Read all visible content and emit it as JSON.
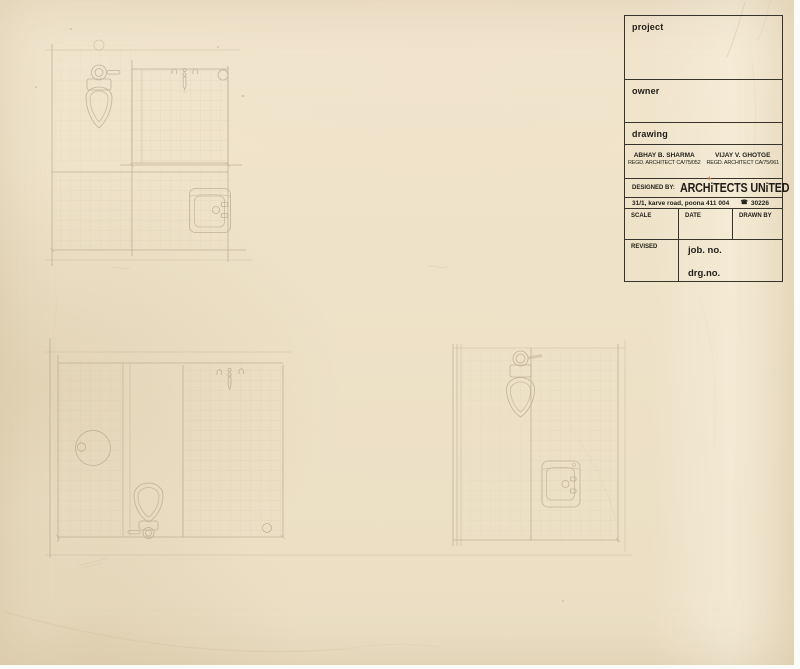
{
  "title_block": {
    "project_label": "project",
    "owner_label": "owner",
    "drawing_label": "drawing",
    "architect_1_name": "ABHAY B. SHARMA",
    "architect_1_reg": "REGD. ARCHITECT CA/75/052",
    "architect_2_name": "VIJAY V. GHOTGE",
    "architect_2_reg": "REGD. ARCHITECT CA/75/061",
    "designed_by_label": "DESIGNED BY:",
    "firm_name": "ARCHiTECTS UNiTED",
    "address": "31/1, karve road, poona 411 004",
    "phone_icon": "☎",
    "phone_number": "30226",
    "stray_mark": "+",
    "scale_label": "SCALE",
    "date_label": "DATE",
    "drawn_by_label": "DRAWN BY",
    "revised_label": "REVISED",
    "job_no_label": "job. no.",
    "drg_no_label": "drg.no."
  },
  "colors": {
    "paper": "#eee2c8",
    "ink": "#38332b",
    "pencil": "#a3947c",
    "accent_mark": "#c9713c"
  }
}
